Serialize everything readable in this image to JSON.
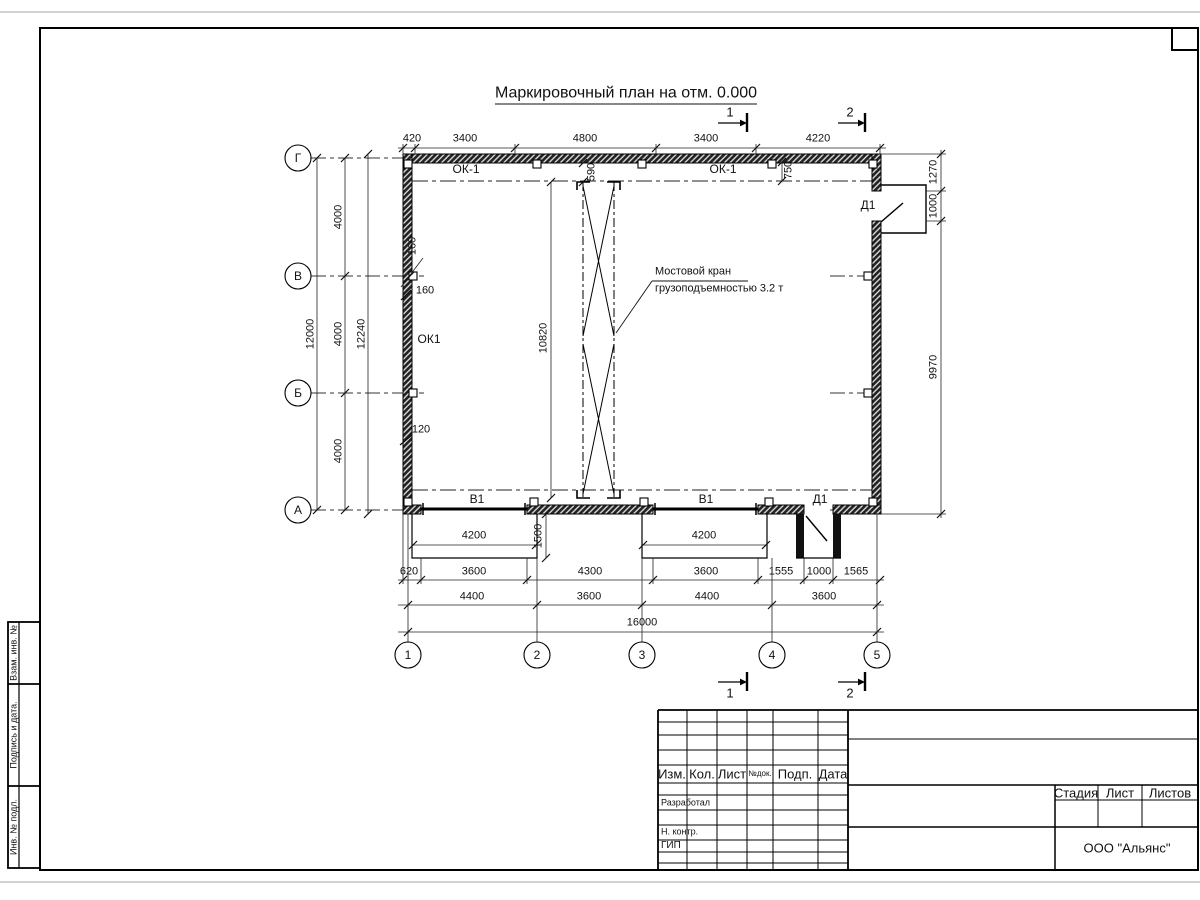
{
  "title": "Маркировочный план на отм. 0.000",
  "axes": {
    "rows": [
      "Г",
      "В",
      "Б",
      "А"
    ],
    "cols": [
      "1",
      "2",
      "3",
      "4",
      "5"
    ]
  },
  "dims": {
    "top": [
      "420",
      "3400",
      "4800",
      "3400",
      "4220"
    ],
    "left": {
      "overall": "12000",
      "segments": [
        "4000",
        "4000",
        "4000"
      ],
      "outer": "12240"
    },
    "right": [
      "1270",
      "1000",
      "9970"
    ],
    "bottom_row1": [
      "620",
      "3600",
      "4300",
      "3600",
      "1555",
      "1000",
      "1565"
    ],
    "bottom_row2": [
      "4400",
      "3600",
      "4400",
      "3600"
    ],
    "bottom_total": "16000",
    "ramp_width": "4200",
    "ramp_depth": "1500",
    "crane_span": "10820",
    "offset_590": "590",
    "offset_750": "750",
    "offset_160a": "160",
    "offset_160b": "160",
    "offset_120": "120"
  },
  "labels": {
    "window_top_left": "ОК-1",
    "window_top_right": "ОК-1",
    "window_left": "ОК1",
    "gate1": "В1",
    "gate2": "В1",
    "door_top": "Д1",
    "door_bottom": "Д1"
  },
  "crane_note": {
    "line1": "Мостовой кран",
    "line2": "грузоподъемностью 3.2 т"
  },
  "sections": {
    "s1": "1",
    "s2": "2"
  },
  "titleblock": {
    "headers": [
      "Изм.",
      "Кол.",
      "Лист",
      "№док.",
      "Подп.",
      "Дата"
    ],
    "roles": [
      "Разработал",
      "Н. контр.",
      "ГИП"
    ],
    "stage_headers": [
      "Стадия",
      "Лист",
      "Листов"
    ],
    "company": "ООО \"Альянс\""
  },
  "sidebar": [
    "Взам. инв. №",
    "Подпись и дата.",
    "Инв. № подл."
  ]
}
